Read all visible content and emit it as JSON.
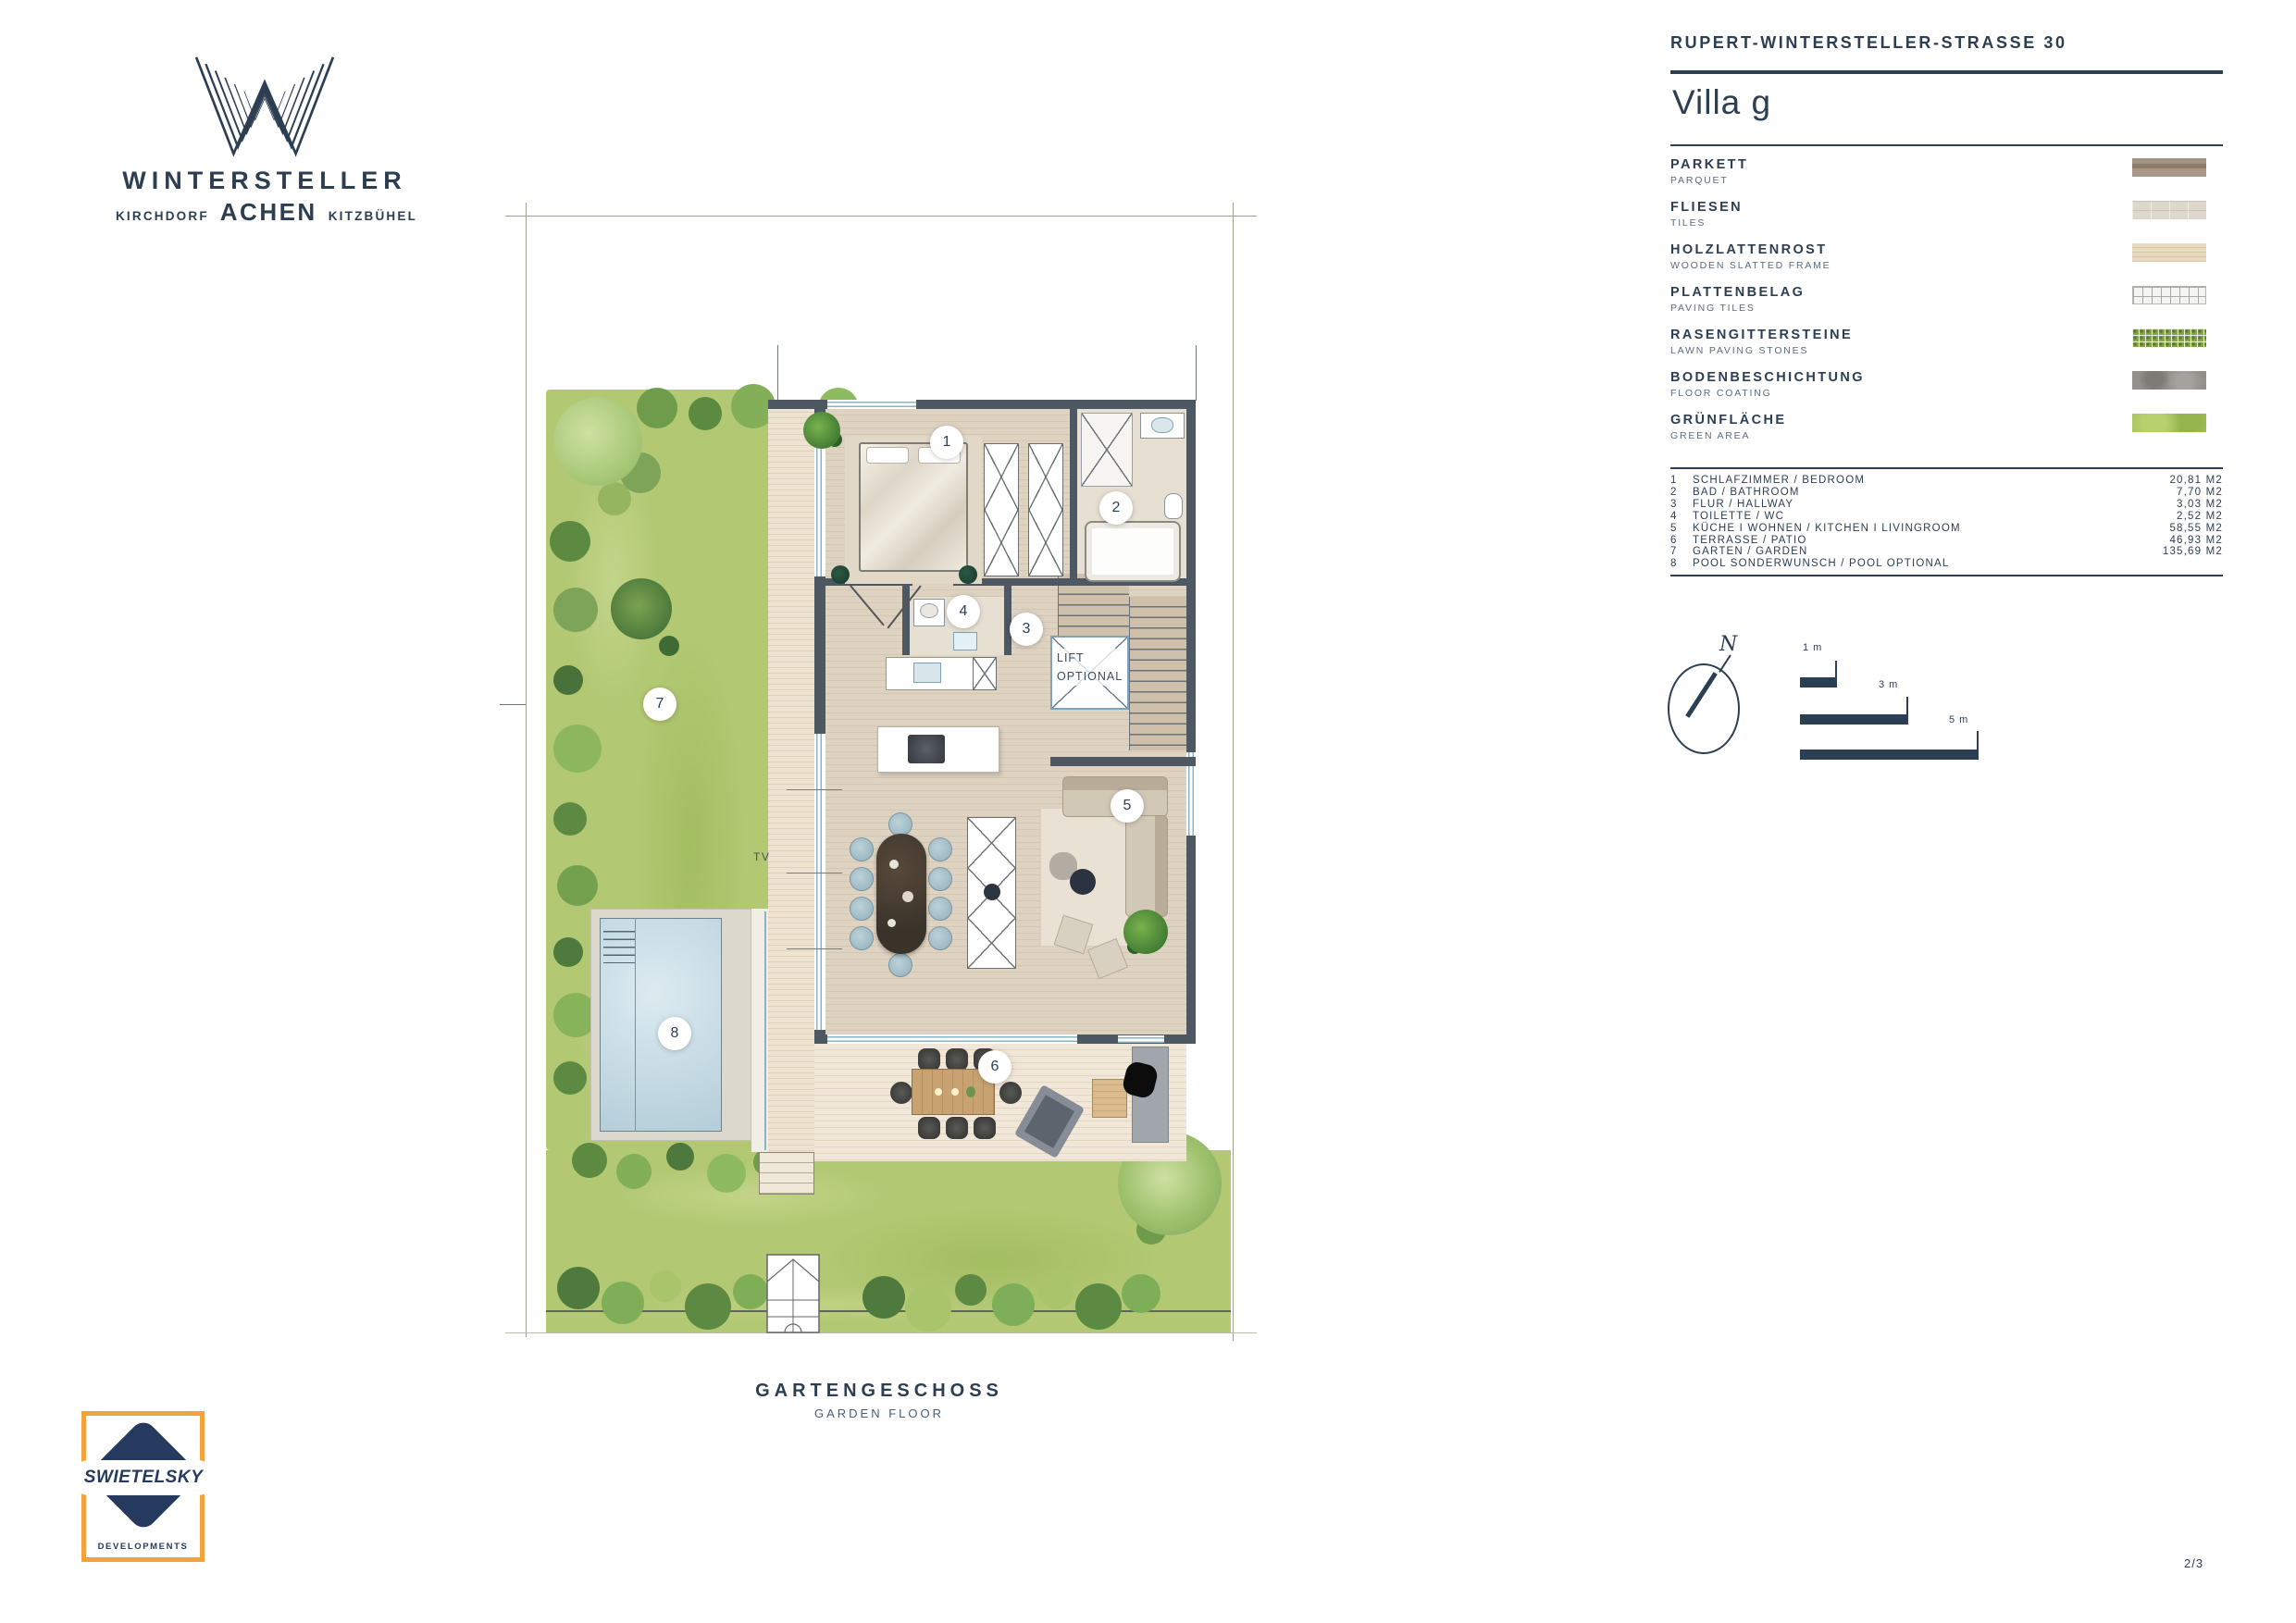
{
  "brand": {
    "name": "WINTERSTELLER",
    "city_left": "KIRCHDORF",
    "city_center": "ACHEN",
    "city_right": "KITZBÜHEL"
  },
  "header": {
    "address": "RUPERT-WINTERSTELLER-STRASSE 30",
    "title": "Villa g"
  },
  "legend": {
    "items": [
      {
        "de": "PARKETT",
        "en": "PARQUET"
      },
      {
        "de": "FLIESEN",
        "en": "TILES"
      },
      {
        "de": "HOLZLATTENROST",
        "en": "WOODEN SLATTED FRAME"
      },
      {
        "de": "PLATTENBELAG",
        "en": "PAVING TILES"
      },
      {
        "de": "RASENGITTERSTEINE",
        "en": "LAWN PAVING STONES"
      },
      {
        "de": "BODENBESCHICHTUNG",
        "en": "FLOOR COATING"
      },
      {
        "de": "GRÜNFLÄCHE",
        "en": "GREEN AREA"
      }
    ]
  },
  "room_list": {
    "rows": [
      {
        "nr": "1",
        "name": "SCHLAFZIMMER / BEDROOM",
        "area": "20,81 M2"
      },
      {
        "nr": "2",
        "name": "BAD / BATHROOM",
        "area": "7,70 M2"
      },
      {
        "nr": "3",
        "name": "FLUR / HALLWAY",
        "area": "3,03 M2"
      },
      {
        "nr": "4",
        "name": "TOILETTE / WC",
        "area": "2,52 M2"
      },
      {
        "nr": "5",
        "name": "KÜCHE I WOHNEN / KITCHEN I LIVINGROOM",
        "area": "58,55 M2"
      },
      {
        "nr": "6",
        "name": "TERRASSE / PATIO",
        "area": "46,93 M2"
      },
      {
        "nr": "7",
        "name": "GARTEN / GARDEN",
        "area": "135,69 M2"
      },
      {
        "nr": "8",
        "name": "POOL SONDERWUNSCH / POOL OPTIONAL",
        "area": ""
      }
    ]
  },
  "compass": {
    "north": "N"
  },
  "scalebar": {
    "labels": [
      "1 m",
      "3 m",
      "5 m"
    ]
  },
  "plan": {
    "tv": "TV",
    "lift_line1": "LIFT",
    "lift_line2": "OPTIONAL",
    "badges": [
      "1",
      "2",
      "3",
      "4",
      "5",
      "6",
      "7",
      "8"
    ]
  },
  "caption": {
    "title": "GARTENGESCHOSS",
    "subtitle": "GARDEN FLOOR"
  },
  "developer": {
    "name": "SWIETELSKY",
    "division": "DEVELOPMENTS"
  },
  "page_number": "2/3",
  "colors": {
    "navy": "#2c3e52",
    "orange": "#f2a33c",
    "grass": "#b2c873",
    "pool_water": "#c6dbe4"
  }
}
